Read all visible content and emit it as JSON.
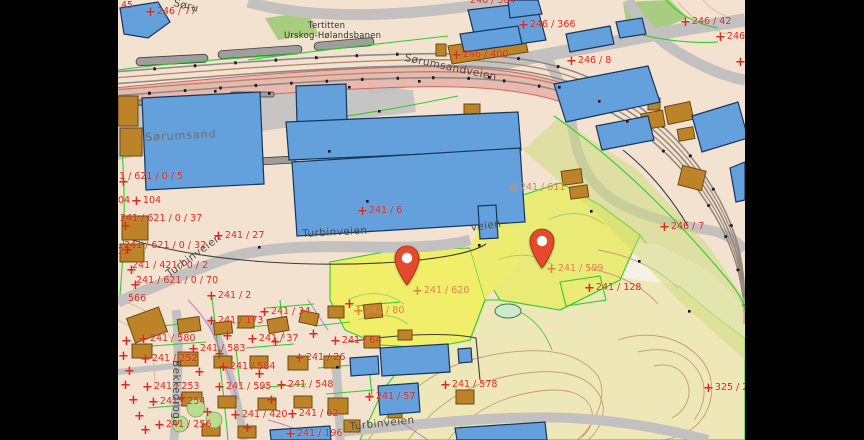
{
  "palette": {
    "map-base": "#f3e2cf",
    "label-red": "#dc2a1f",
    "label-orange": "#e2813c",
    "street": "#4a4a48",
    "place": "#6d6d6b",
    "poi": "#2f2f2d",
    "pin": "#e54a2d",
    "building-blue": "#64a0dc",
    "building-outline": "#16365c",
    "building-tan": "#bd8329",
    "yellow-parcel": "#f1ee69",
    "pale-yellow": "#eee8b8",
    "road-gray": "#c3c1bf",
    "green-line": "#2ccd2c",
    "pink-strip": "#eab9ae"
  },
  "glyphs": {
    "cross": "+"
  },
  "parcel_labels": [
    {
      "text": "45",
      "x": 3,
      "y": 1,
      "color": "red",
      "cross": false
    },
    {
      "text": "246 / 77",
      "x": 27,
      "y": 7,
      "color": "red",
      "cross": true
    },
    {
      "text": "246 / 364",
      "x": 352,
      "y": -4,
      "color": "red",
      "cross": false
    },
    {
      "text": "246 / 366",
      "x": 400,
      "y": 20,
      "color": "red",
      "cross": true
    },
    {
      "text": "246 / 400",
      "x": 333,
      "y": 50,
      "color": "red",
      "cross": true
    },
    {
      "text": "246 / 8",
      "x": 448,
      "y": 56,
      "color": "red",
      "cross": true
    },
    {
      "text": "246 / 42",
      "x": 562,
      "y": 17,
      "color": "red",
      "cross": true
    },
    {
      "text": "246 /",
      "x": 597,
      "y": 32,
      "color": "red",
      "cross": true
    },
    {
      "text": "246 / 7",
      "x": 541,
      "y": 222,
      "color": "red",
      "cross": true
    },
    {
      "text": "241 / 611",
      "x": 390,
      "y": 183,
      "color": "orange",
      "cross": true
    },
    {
      "text": "241 / 6",
      "x": 239,
      "y": 206,
      "color": "red",
      "cross": true
    },
    {
      "text": "241 / 620",
      "x": 294,
      "y": 286,
      "color": "orange",
      "cross": true
    },
    {
      "text": "241 / 599",
      "x": 428,
      "y": 264,
      "color": "orange",
      "cross": true
    },
    {
      "text": "241 / 128",
      "x": 466,
      "y": 283,
      "color": "red",
      "cross": true
    },
    {
      "text": "241 / 80",
      "x": 235,
      "y": 306,
      "color": "orange",
      "cross": true
    },
    {
      "text": "241 / 64",
      "x": 212,
      "y": 336,
      "color": "red",
      "cross": true
    },
    {
      "text": "241 / 578",
      "x": 322,
      "y": 380,
      "color": "red",
      "cross": true
    },
    {
      "text": "241 / 57",
      "x": 246,
      "y": 392,
      "color": "red",
      "cross": true
    },
    {
      "text": "325 / 23",
      "x": 585,
      "y": 383,
      "color": "red",
      "cross": true
    },
    {
      "text": "241 / 27",
      "x": 95,
      "y": 231,
      "color": "red",
      "cross": true
    },
    {
      "text": "1 / 621 / 0 / 5",
      "x": 1,
      "y": 172,
      "color": "red",
      "cross": false
    },
    {
      "text": "04",
      "x": 0,
      "y": 196,
      "color": "red",
      "cross": false
    },
    {
      "text": "104",
      "x": 13,
      "y": 196,
      "color": "red",
      "cross": true
    },
    {
      "text": "241 / 621 / 0 / 37",
      "x": 2,
      "y": 214,
      "color": "red",
      "cross": false
    },
    {
      "text": "22",
      "x": 0,
      "y": 247,
      "color": "red",
      "cross": false
    },
    {
      "text": "241 / 621 / 0 / 32",
      "x": 6,
      "y": 241,
      "color": "red",
      "cross": false
    },
    {
      "text": "241 / 421 / 0 / 2",
      "x": 14,
      "y": 261,
      "color": "red",
      "cross": false
    },
    {
      "text": "241 / 621 / 0 / 70",
      "x": 18,
      "y": 276,
      "color": "red",
      "cross": false
    },
    {
      "text": "566",
      "x": 10,
      "y": 294,
      "color": "red",
      "cross": false
    },
    {
      "text": "241 / 2",
      "x": 88,
      "y": 291,
      "color": "red",
      "cross": true
    },
    {
      "text": "241 / 34",
      "x": 141,
      "y": 307,
      "color": "red",
      "cross": true
    },
    {
      "text": "241 / 173",
      "x": 88,
      "y": 316,
      "color": "red",
      "cross": true
    },
    {
      "text": "241 / 580",
      "x": 20,
      "y": 334,
      "color": "red",
      "cross": true
    },
    {
      "text": "241 / 37",
      "x": 129,
      "y": 334,
      "color": "red",
      "cross": true
    },
    {
      "text": "241 / 583",
      "x": 70,
      "y": 344,
      "color": "red",
      "cross": true
    },
    {
      "text": "241 / 252",
      "x": 22,
      "y": 354,
      "color": "red",
      "cross": true
    },
    {
      "text": "241 / 26",
      "x": 176,
      "y": 353,
      "color": "red",
      "cross": true
    },
    {
      "text": "241 / 584",
      "x": 100,
      "y": 362,
      "color": "red",
      "cross": true
    },
    {
      "text": "241 / 253",
      "x": 24,
      "y": 382,
      "color": "red",
      "cross": true
    },
    {
      "text": "241 / 595",
      "x": 96,
      "y": 382,
      "color": "red",
      "cross": true
    },
    {
      "text": "241 / 548",
      "x": 158,
      "y": 380,
      "color": "red",
      "cross": true
    },
    {
      "text": "241 / 254",
      "x": 30,
      "y": 397,
      "color": "red",
      "cross": true
    },
    {
      "text": "241 / 420",
      "x": 112,
      "y": 410,
      "color": "red",
      "cross": true
    },
    {
      "text": "241 / 62",
      "x": 169,
      "y": 409,
      "color": "red",
      "cross": true
    },
    {
      "text": "241 / 256",
      "x": 36,
      "y": 420,
      "color": "red",
      "cross": true
    },
    {
      "text": "241 / 196",
      "x": 167,
      "y": 429,
      "color": "red",
      "cross": true
    }
  ],
  "street_labels": [
    {
      "text": "Søru",
      "x": 57,
      "y": -3,
      "rot": 14,
      "cls": "street"
    },
    {
      "text": "Sørumsand",
      "x": 27,
      "y": 131,
      "rot": -3,
      "cls": "place"
    },
    {
      "text": "Tertitten",
      "x": 190,
      "y": 21,
      "rot": 0,
      "cls": "poi"
    },
    {
      "text": "Urskog-Hølandsbanen",
      "x": 166,
      "y": 31,
      "rot": 0,
      "cls": "poi"
    },
    {
      "text": "Sørumsandveien",
      "x": 288,
      "y": 52,
      "rot": 12,
      "cls": "street"
    },
    {
      "text": "Turbinveien",
      "x": 184,
      "y": 228,
      "rot": -3,
      "cls": "street"
    },
    {
      "text": "veien",
      "x": 352,
      "y": 222,
      "rot": -8,
      "cls": "street"
    },
    {
      "text": "Turbinveien",
      "x": 46,
      "y": 270,
      "rot": -36,
      "cls": "street"
    },
    {
      "text": "Bekkedroga",
      "x": 64,
      "y": 360,
      "rot": 90,
      "cls": "street"
    },
    {
      "text": "Turbinveien",
      "x": 231,
      "y": 421,
      "rot": -6,
      "cls": "street"
    }
  ],
  "crosses": [
    {
      "x": 0,
      "y": 178
    },
    {
      "x": 2,
      "y": 222
    },
    {
      "x": 4,
      "y": 246
    },
    {
      "x": 8,
      "y": 266
    },
    {
      "x": 12,
      "y": 281
    },
    {
      "x": 3,
      "y": 337
    },
    {
      "x": 0,
      "y": 352
    },
    {
      "x": 6,
      "y": 367
    },
    {
      "x": 2,
      "y": 381
    },
    {
      "x": 10,
      "y": 396
    },
    {
      "x": 16,
      "y": 412
    },
    {
      "x": 22,
      "y": 426
    },
    {
      "x": 617,
      "y": 58
    },
    {
      "x": 152,
      "y": 338
    },
    {
      "x": 104,
      "y": 332
    },
    {
      "x": 96,
      "y": 350
    },
    {
      "x": 136,
      "y": 370
    },
    {
      "x": 76,
      "y": 368
    },
    {
      "x": 58,
      "y": 394
    },
    {
      "x": 84,
      "y": 408
    },
    {
      "x": 124,
      "y": 424
    },
    {
      "x": 148,
      "y": 396
    },
    {
      "x": 190,
      "y": 330
    },
    {
      "x": 226,
      "y": 300
    }
  ],
  "pins": [
    {
      "name": "pin-241-620",
      "tip_x": 289,
      "tip_y": 285
    },
    {
      "name": "pin-241-599",
      "tip_x": 424,
      "tip_y": 268
    }
  ]
}
